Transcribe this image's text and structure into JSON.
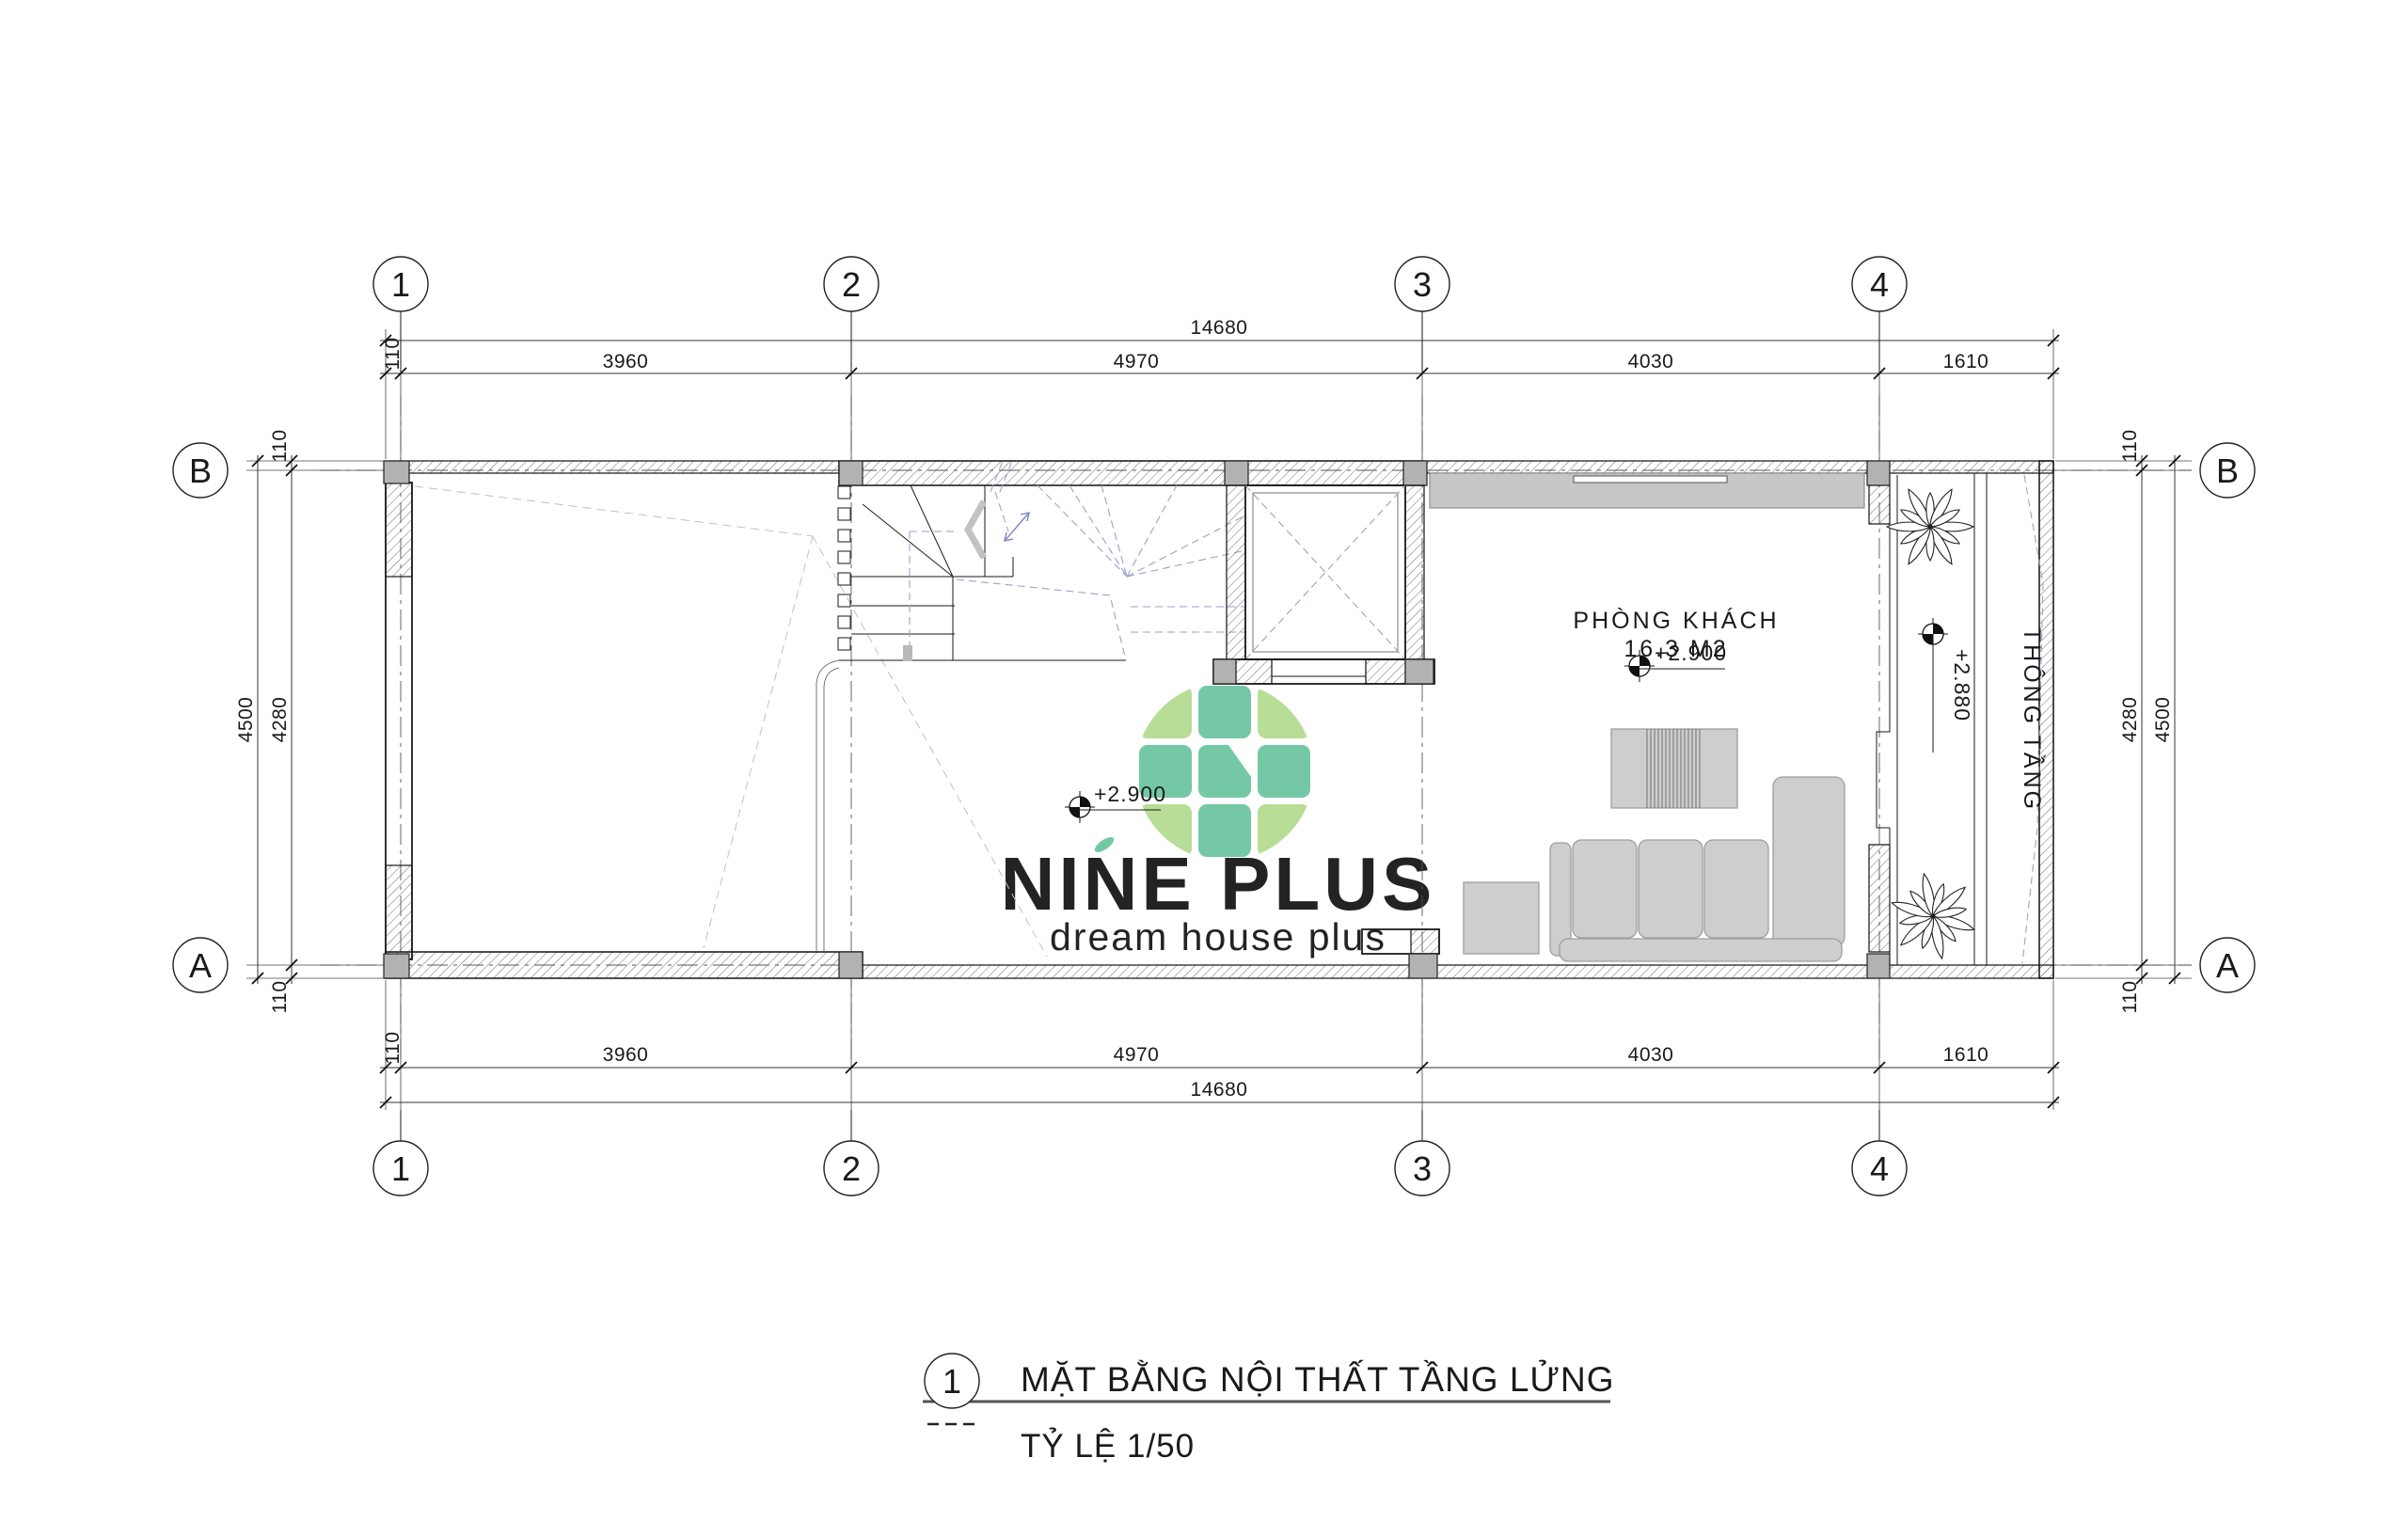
{
  "drawing": {
    "number": "1",
    "title": "MẶT BẰNG NỘI THẤT TẦNG LỬNG",
    "scale": "TỶ LỆ 1/50"
  },
  "logo": {
    "brand": "NINE PLUS",
    "tagline": "dream house plus"
  },
  "grid": {
    "cols": [
      "1",
      "2",
      "3",
      "4"
    ],
    "rows": [
      "B",
      "A"
    ]
  },
  "dims": {
    "h_overall": "14680",
    "h_seg": [
      "110",
      "3960",
      "4970",
      "4030",
      "1610"
    ],
    "v_overall": "4500",
    "v_inner": "4280",
    "v_side": "110"
  },
  "rooms": {
    "living": {
      "name": "PHÒNG KHÁCH",
      "area": "16.3 M2",
      "level": "+2.900"
    },
    "hall": {
      "level": "+2.900"
    },
    "void": {
      "name": "THÔNG TẦNG",
      "level": "+2.880"
    }
  },
  "colors": {
    "tile_green": "#6fc6a2",
    "tile_light": "#b5dc92",
    "brand_text": "#abd99c",
    "tagline_teal": "#5ec3a6",
    "dash_blue": "#9aa2cc",
    "column_gray": "#b2b2b2",
    "furniture_gray": "#cecece"
  }
}
